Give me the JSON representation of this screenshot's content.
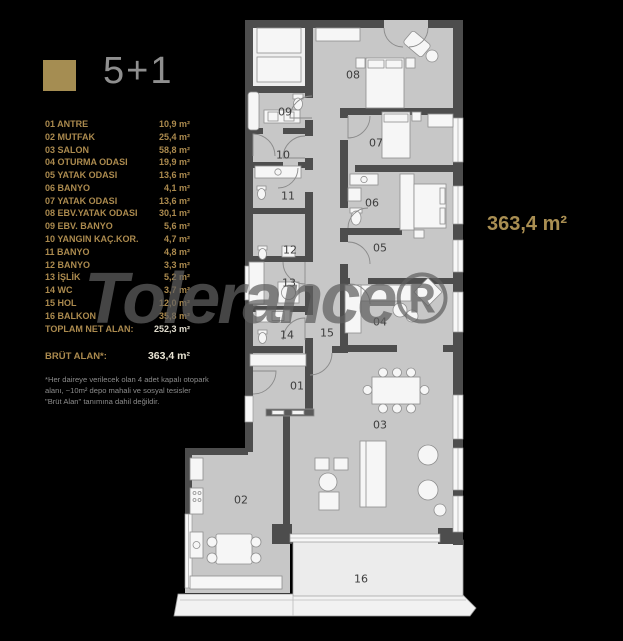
{
  "header": {
    "title": "5+1"
  },
  "colors": {
    "accent_gold": "#a58d52",
    "title_gray": "#8f8f8f",
    "wall_gray": "#4d4d4d",
    "floor_gray": "#c7c7c7"
  },
  "legend": {
    "items": [
      {
        "label": "01 ANTRE",
        "value": "10,9 m²"
      },
      {
        "label": "02 MUTFAK",
        "value": "25,4 m²"
      },
      {
        "label": "03 SALON",
        "value": "58,8 m²"
      },
      {
        "label": "04 OTURMA ODASI",
        "value": "19,9 m²"
      },
      {
        "label": "05 YATAK ODASI",
        "value": "13,6 m²"
      },
      {
        "label": "06 BANYO",
        "value": "4,1 m²"
      },
      {
        "label": "07 YATAK ODASI",
        "value": "13,6 m²"
      },
      {
        "label": "08 EBV.YATAK ODASI",
        "value": "30,1 m²"
      },
      {
        "label": "09 EBV. BANYO",
        "value": "5,6 m²"
      },
      {
        "label": "10 YANGIN KAÇ.KOR.",
        "value": "4,7 m²"
      },
      {
        "label": "11 BANYO",
        "value": "4,8 m²"
      },
      {
        "label": "12 BANYO",
        "value": "3,3 m²"
      },
      {
        "label": "13 İŞLİK",
        "value": "5,2 m²"
      },
      {
        "label": "14 WC",
        "value": "3,7 m²"
      },
      {
        "label": "15 HOL",
        "value": "12,0 m²"
      },
      {
        "label": "16 BALKON",
        "value": "35,8 m²"
      }
    ],
    "total": {
      "label": "TOPLAM NET ALAN:",
      "value": "252,3 m²"
    }
  },
  "brut": {
    "label": "BRÜT ALAN*:",
    "value": "363,4 m²"
  },
  "footnote": "*Her daireye verilecek olan 4 adet kapalı otopark alanı, ~10m² depo mahali ve sosyal tesisler \"Brüt Alan\" tanımına dahil değildir.",
  "area_callout": "363,4 m²",
  "watermark": "Tolerance®",
  "plan": {
    "rooms": [
      {
        "number": "01",
        "x": 297,
        "y": 386
      },
      {
        "number": "02",
        "x": 241,
        "y": 500
      },
      {
        "number": "03",
        "x": 380,
        "y": 425
      },
      {
        "number": "04",
        "x": 380,
        "y": 322
      },
      {
        "number": "05",
        "x": 380,
        "y": 248
      },
      {
        "number": "06",
        "x": 372,
        "y": 203
      },
      {
        "number": "07",
        "x": 376,
        "y": 143
      },
      {
        "number": "08",
        "x": 353,
        "y": 75
      },
      {
        "number": "09",
        "x": 285,
        "y": 112
      },
      {
        "number": "10",
        "x": 283,
        "y": 155
      },
      {
        "number": "11",
        "x": 288,
        "y": 196
      },
      {
        "number": "12",
        "x": 290,
        "y": 250
      },
      {
        "number": "13",
        "x": 289,
        "y": 283
      },
      {
        "number": "14",
        "x": 287,
        "y": 335
      },
      {
        "number": "15",
        "x": 327,
        "y": 333
      },
      {
        "number": "16",
        "x": 361,
        "y": 579
      }
    ]
  }
}
